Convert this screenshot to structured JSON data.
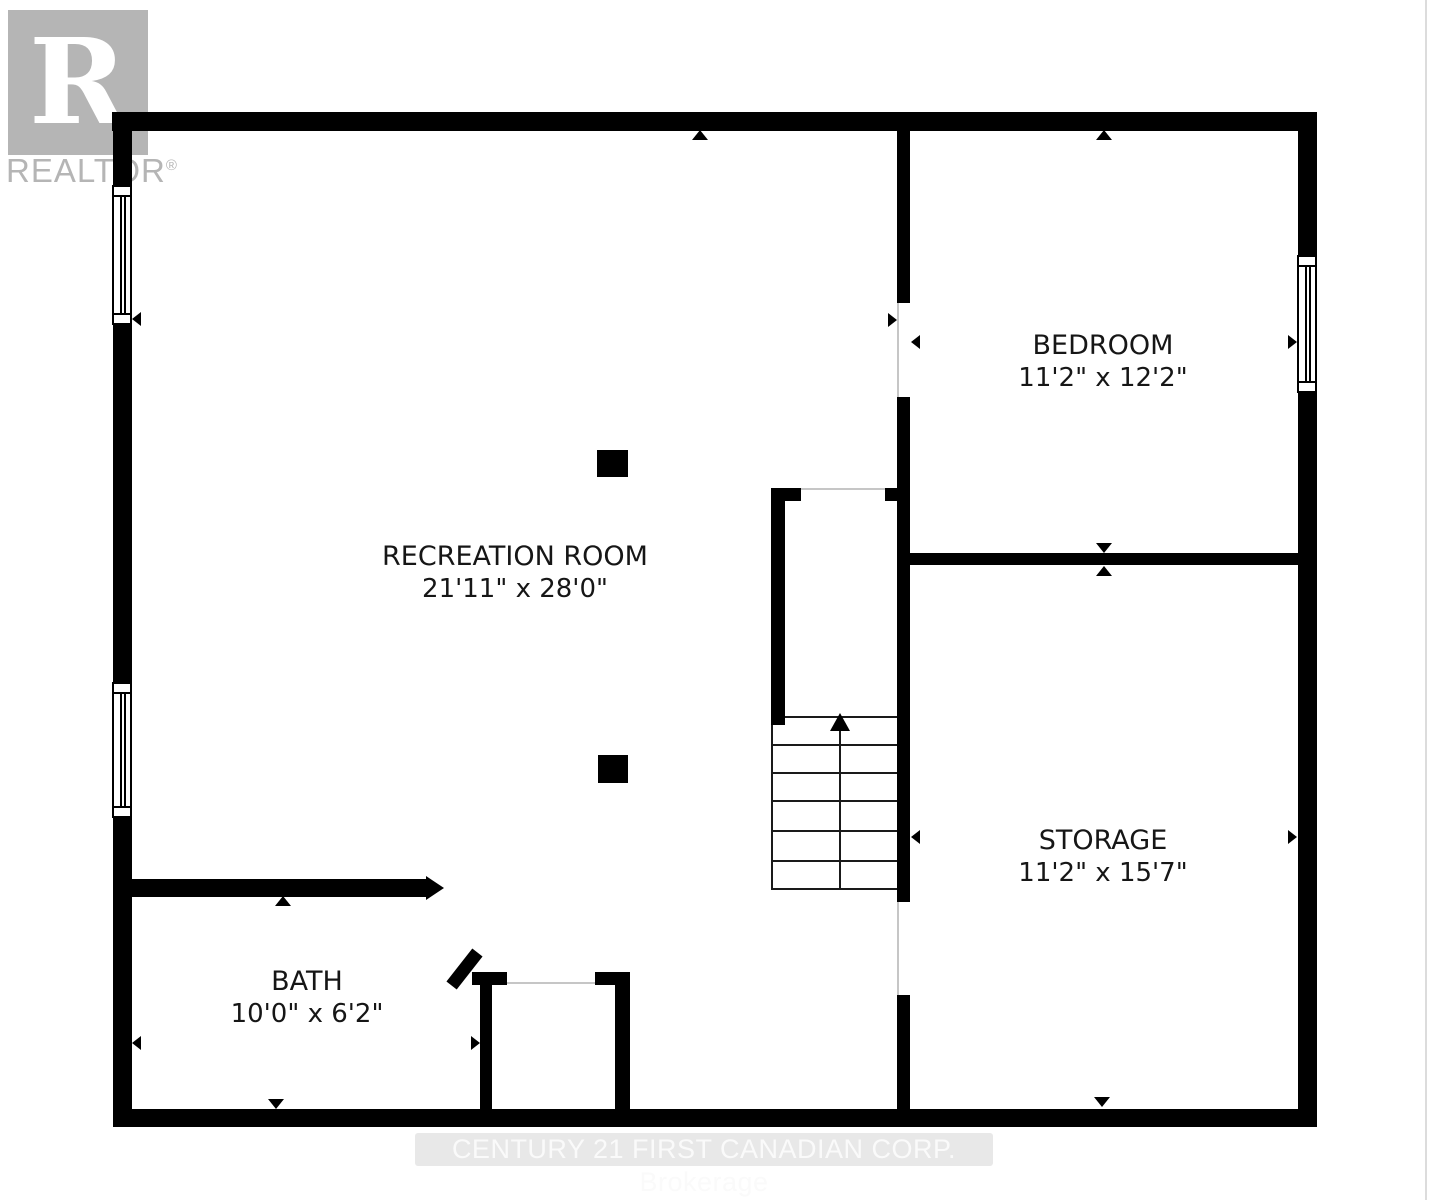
{
  "logo": {
    "letter": "R",
    "name": "REALTOR",
    "registered_mark": "®",
    "color": "#b5b5b5"
  },
  "rooms": [
    {
      "name": "RECREATION ROOM",
      "dimensions": "21'11\" x 28'0\""
    },
    {
      "name": "BEDROOM",
      "dimensions": "11'2\" x 12'2\""
    },
    {
      "name": "STORAGE",
      "dimensions": "11'2\" x 15'7\""
    },
    {
      "name": "BATH",
      "dimensions": "10'0\" x 6'2\""
    }
  ],
  "stairs": {
    "direction": "up"
  },
  "watermark": {
    "text": "CENTURY 21 FIRST CANADIAN CORP. Brokerage"
  },
  "colors": {
    "wall": "#000000",
    "background": "#ffffff",
    "logo_gray": "#b5b5b5",
    "watermark_bg": "#e8e8e8",
    "watermark_text": "#fafafa"
  }
}
